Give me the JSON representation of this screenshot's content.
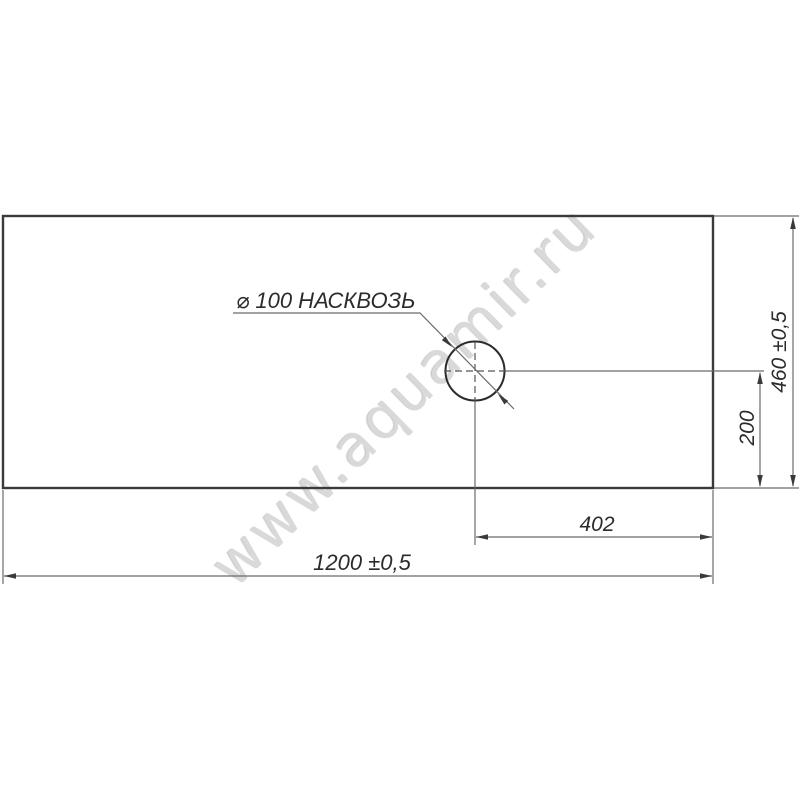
{
  "labels": {
    "hole": "⌀ 100 НАСКВОЗЬ",
    "width": "1200 ±0,5",
    "height": "460 ±0,5",
    "hole_from_right": "402",
    "hole_from_bottom": "200"
  },
  "watermark": "www.aquamir.ru",
  "colors": {
    "background": "#ffffff",
    "outline": "#3a3a3a",
    "dimension_lines": "#6a6a6a",
    "centerline": "#555555",
    "text": "#2b2b2b",
    "watermark": "#d9d9d9"
  }
}
